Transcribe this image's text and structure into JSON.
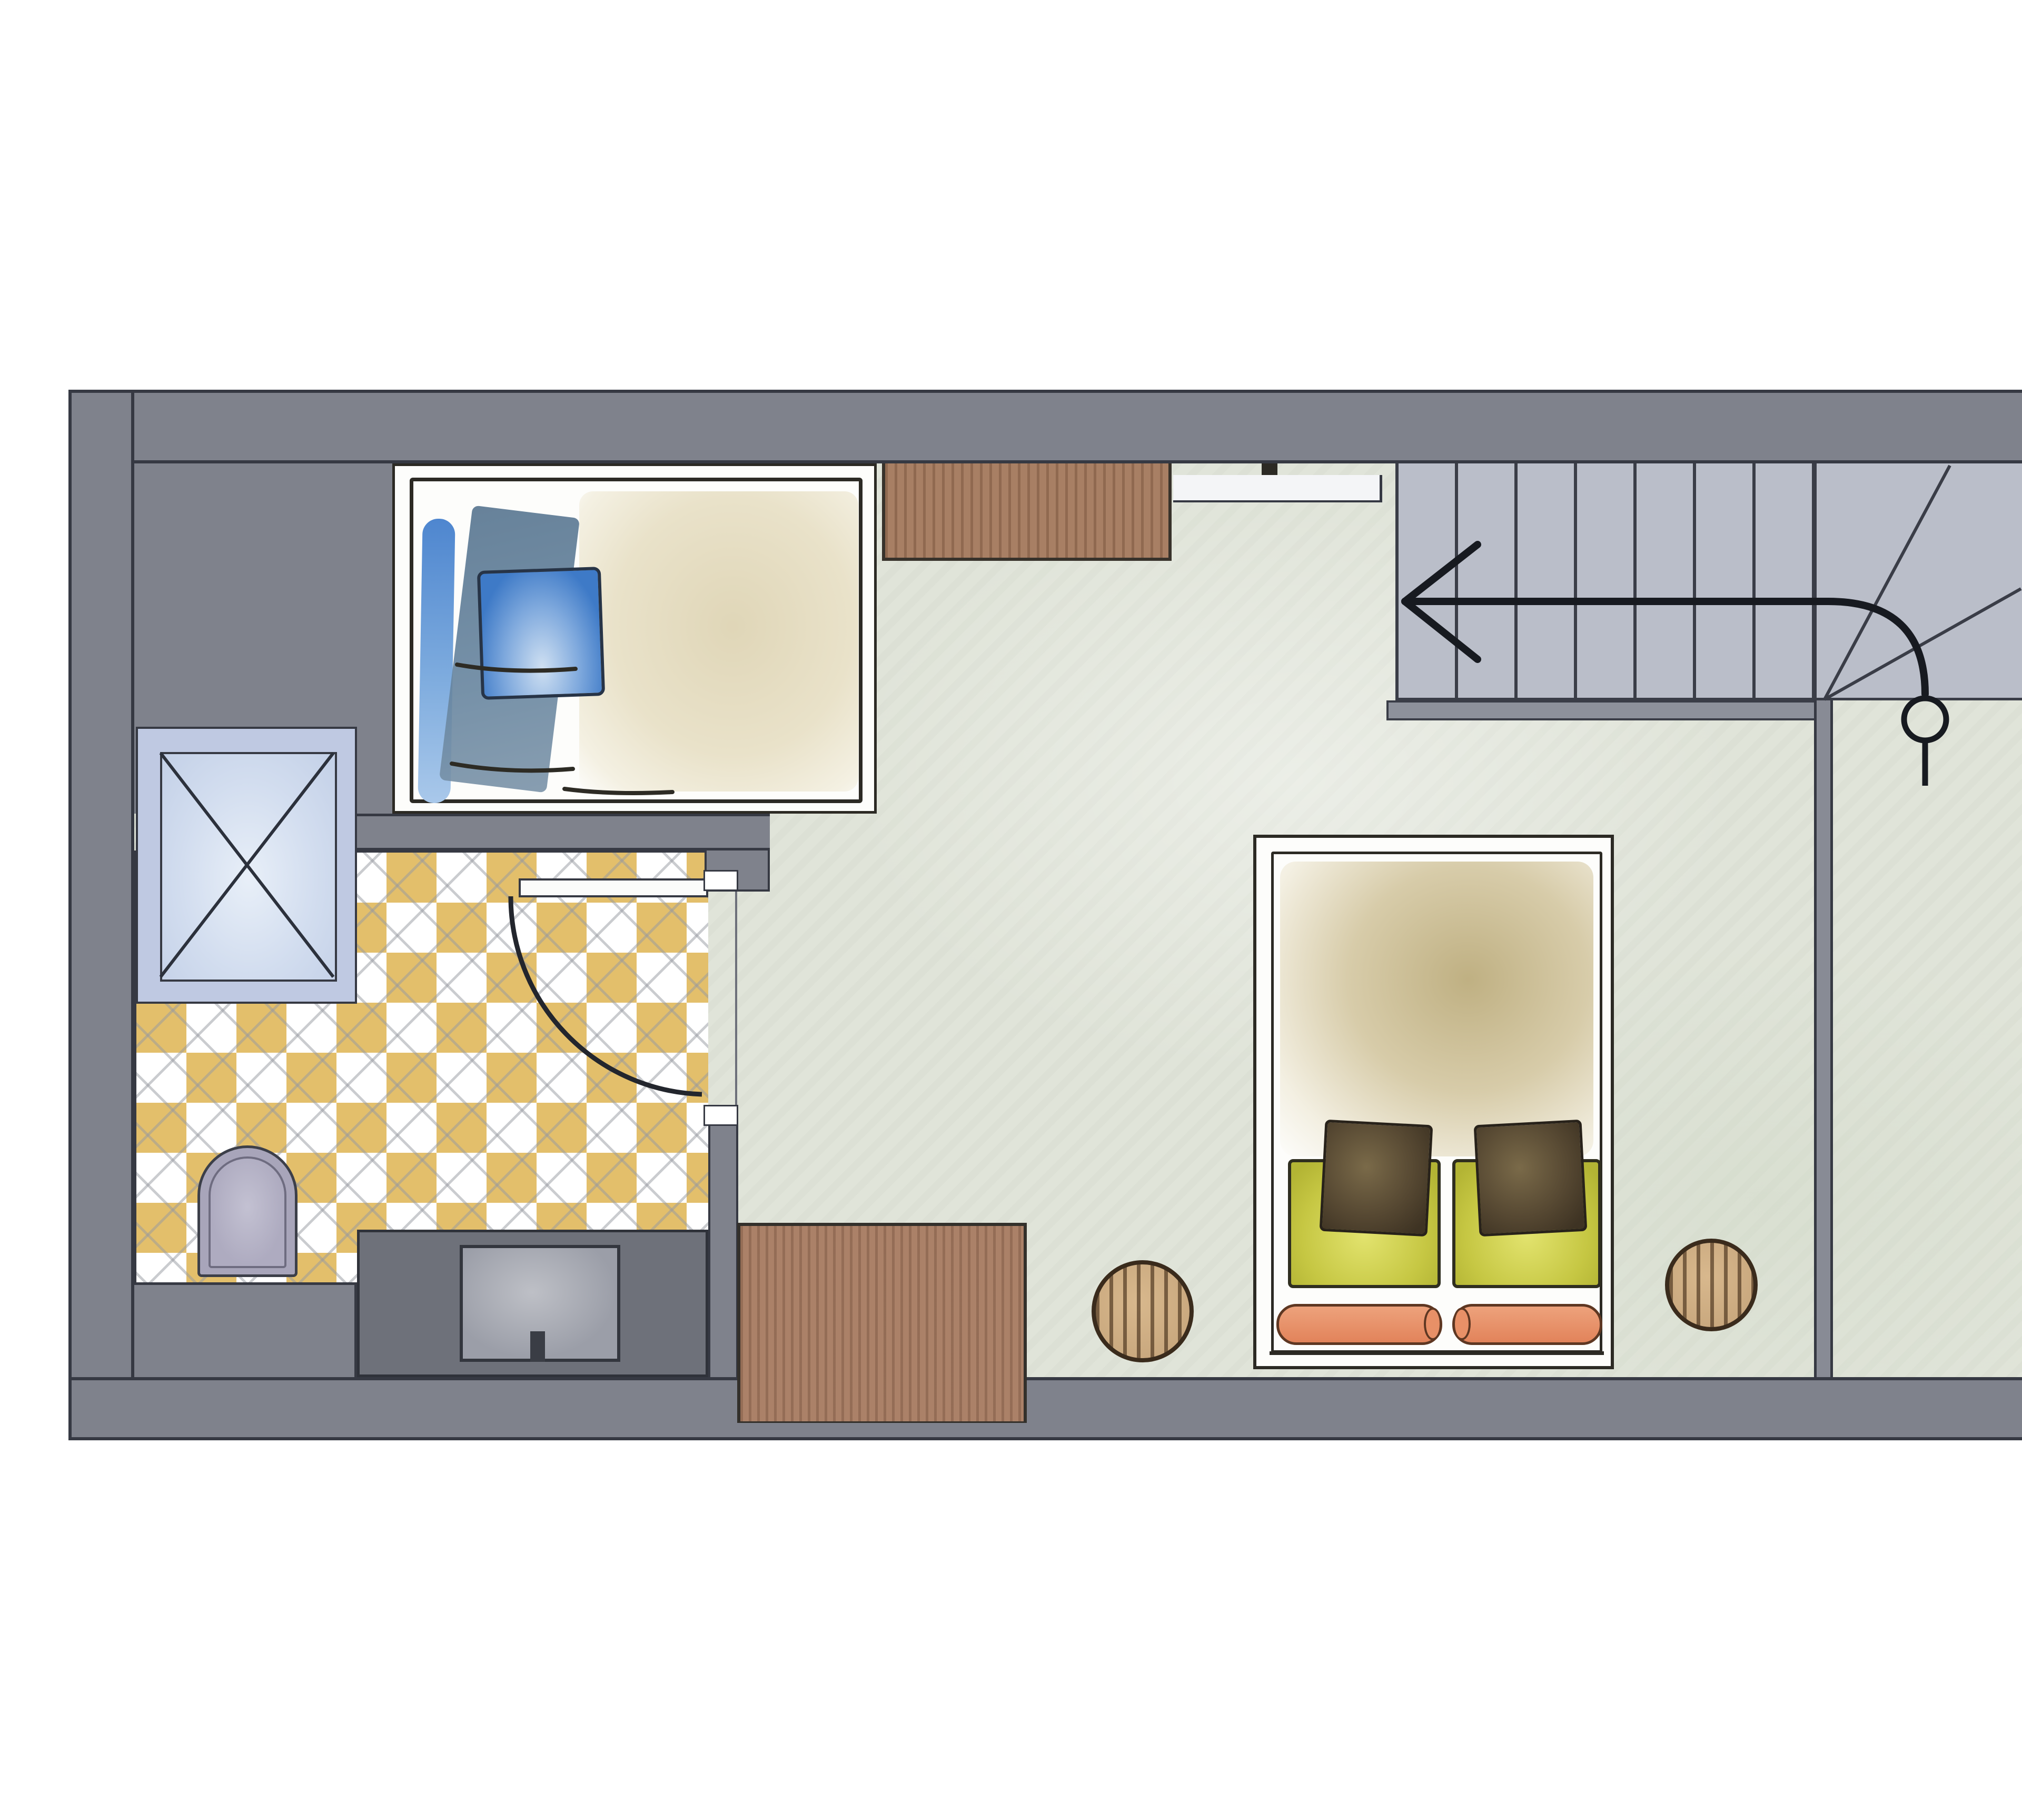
{
  "document": {
    "type": "architectural floor plan",
    "style": "watercolor sketch plan, cut off at right edge of image",
    "visible_text": []
  },
  "palette": {
    "wall": "#7f828c",
    "ink": "#2c2a24",
    "ink2": "#363943",
    "floor": "#e0e4d9",
    "tileyellow": "#e3bf6b",
    "tilewhite": "#ffffff",
    "stairs": "#babec9",
    "stairline": "#3a3d47",
    "showerframe": "#bfc9e2",
    "toilet": "#a8a5ba",
    "counter": "#6e717a",
    "sink": "#9b9ea8",
    "cabinet": "#a87f64",
    "bench": "#ab8168",
    "stool": "#c9a87e",
    "pillowblue": "#3e7ac7",
    "pillowgreen": "#c6c743",
    "bolster": "#e88f66"
  },
  "rooms": [
    {
      "id": "sleeping-alcove",
      "label": "Sleeping alcove with single bed (blue pillows, beige duvet)"
    },
    {
      "id": "bathroom",
      "label": "Bathroom with yellow-white diagonal checkerboard tiles"
    },
    {
      "id": "main-room",
      "label": "Main room with sage-green floor and double bed"
    },
    {
      "id": "staircase",
      "label": "Staircase with seven straight treads and three winders"
    },
    {
      "id": "adjacent-room",
      "label": "Adjacent room, cropped by right image edge"
    }
  ],
  "furniture": {
    "single_bed": {
      "label": "Single bed with blue pillow, steel-blue throw and beige duvet"
    },
    "wardrobe": {
      "label": "Wooden wardrobe / sideboard on top wall"
    },
    "window_niche": {
      "label": "Window niche marking in top wall"
    },
    "shower": {
      "label": "Shower tray with X cross symbol"
    },
    "toilet": {
      "label": "Toilet"
    },
    "vanity": {
      "label": "Vanity counter with washbasin and tap"
    },
    "bathroom_door": {
      "label": "Bathroom door with 90-degree swing arc"
    },
    "double_bed": {
      "label": "Double bed with green pillows, dark cushions and orange bolsters"
    },
    "stool_left": {
      "label": "Round wooden side stool (left of double bed)"
    },
    "stool_right": {
      "label": "Round wooden side stool (right of double bed)"
    },
    "bench": {
      "label": "Wooden sideboard bench at bottom wall"
    }
  },
  "stairs": {
    "straight_treads": 7,
    "winder_treads": 3,
    "direction_symbol": "arrow running left from circular start point at the winders"
  }
}
